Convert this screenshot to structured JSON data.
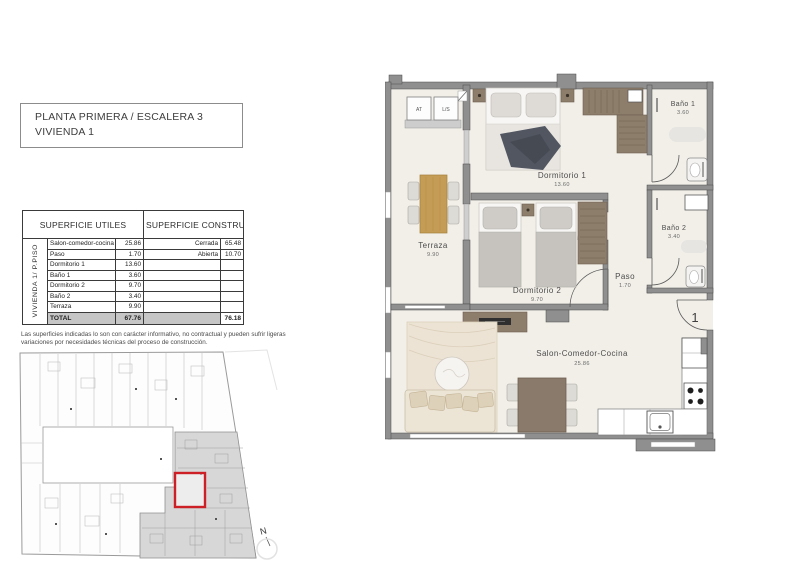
{
  "header": {
    "title_line1": "PLANTA PRIMERA / ESCALERA 3",
    "title_line2": "VIVIENDA 1"
  },
  "surfaces_table": {
    "side_label": "VIVIENDA 1/ P.PISO",
    "utiles_header": "SUPERFICIE UTILES",
    "construidas_header": "SUPERFICIE CONSTRUIDAS",
    "rows": [
      {
        "name": "Salon-comedor-cocina",
        "m2": "25.86",
        "cons_name": "Cerrada",
        "cons_m2": "65.48"
      },
      {
        "name": "Paso",
        "m2": "1.70",
        "cons_name": "Abierta",
        "cons_m2": "10.70"
      },
      {
        "name": "Dormitorio 1",
        "m2": "13.60",
        "cons_name": "",
        "cons_m2": ""
      },
      {
        "name": "Baño 1",
        "m2": "3.60",
        "cons_name": "",
        "cons_m2": ""
      },
      {
        "name": "Dormitorio 2",
        "m2": "9.70",
        "cons_name": "",
        "cons_m2": ""
      },
      {
        "name": "Baño 2",
        "m2": "3.40",
        "cons_name": "",
        "cons_m2": ""
      },
      {
        "name": "Terraza",
        "m2": "9.90",
        "cons_name": "",
        "cons_m2": ""
      }
    ],
    "total": {
      "name": "TOTAL",
      "m2": "67.76",
      "cons_m2": "76.18"
    }
  },
  "disclaimer": "Las superficies indicadas lo son con carácter informativo, no contractual y pueden sufrir ligeras variaciones por necesidades técnicas del proceso de construcción.",
  "floorplan": {
    "rooms": {
      "terraza": {
        "name": "Terraza",
        "area": "9.90"
      },
      "dormitorio1": {
        "name": "Dormitorio 1",
        "area": "13.60"
      },
      "dormitorio2": {
        "name": "Dormitorio 2",
        "area": "9.70"
      },
      "bano1": {
        "name": "Baño 1",
        "area": "3.60"
      },
      "bano2": {
        "name": "Baño 2",
        "area": "3.40"
      },
      "paso": {
        "name": "Paso",
        "area": "1.70"
      },
      "salon": {
        "name": "Salon-Comedor-Cocina",
        "area": "25.86"
      }
    },
    "closets": {
      "at": "AT",
      "ls": "L/S"
    },
    "entrance_number": "1"
  },
  "siteplan": {
    "north_label": "N"
  },
  "colors": {
    "highlight_red": "#cc2026",
    "wall_gray": "#8f8f8f",
    "wood": "#c59c55",
    "furniture_brown": "#8d7d6b",
    "total_row_bg": "#c6c6c6",
    "floor": "#f2efe8",
    "siteplan_shade": "#d7d7d7"
  }
}
